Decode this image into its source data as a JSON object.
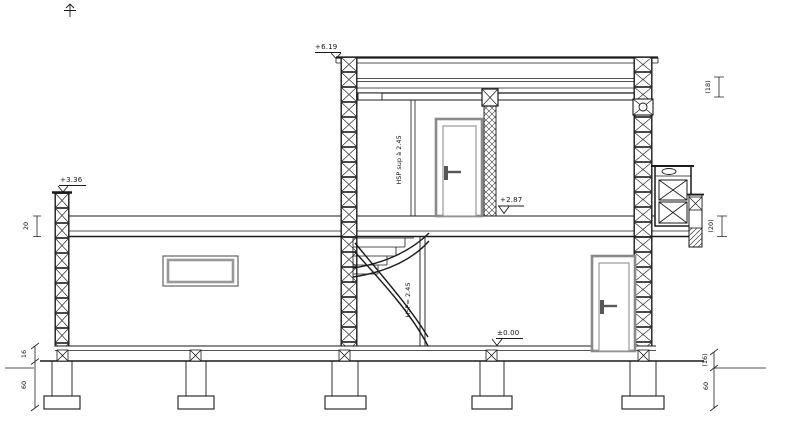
{
  "levels": {
    "right_roof": "+6.19",
    "left_roof": "+3.36",
    "upper_floor": "+2.87",
    "ground_floor": "±0.00"
  },
  "rooms": {
    "upper_height": "HSP sup à 2.45",
    "ground_height": "HSP= 2.45"
  },
  "dims": {
    "left_slab": "20",
    "left_floor": "16",
    "left_footing": "60",
    "right_roof": "(18)",
    "right_slab": "(20)",
    "right_floor": "(16)",
    "right_footing": "60"
  },
  "colors": {
    "line": "#1a1a1a",
    "frame_gray": "#8a8a8a",
    "bg": "#ffffff"
  }
}
